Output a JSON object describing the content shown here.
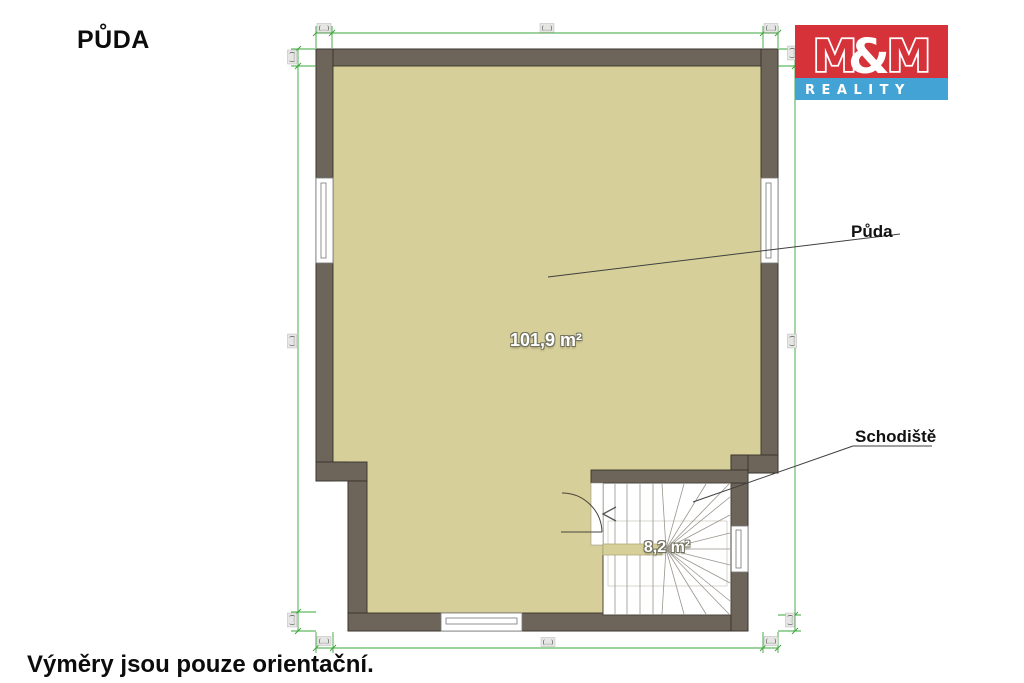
{
  "page": {
    "title": "PŮDA",
    "footer": "Výměry jsou pouze orientační."
  },
  "logo": {
    "m_left": "M",
    "ampersand": "&",
    "m_right": "M",
    "reality": "REALITY",
    "red": "#d6323a",
    "blue": "#44a3d5"
  },
  "plan": {
    "room_label": "Půda",
    "room_area": "101,9 m²",
    "stair_label": "Schodiště",
    "stair_area": "8,2 m²",
    "colors": {
      "floor": "#d7cf99",
      "wall": "#6d655a",
      "dimension_line": "#3aa43a"
    }
  },
  "dims": {
    "top_left": "(…)",
    "top_center": "(…)",
    "top_right": "(…)",
    "bottom_left": "(…)",
    "bottom_center": "(…)",
    "bottom_right": "(…)",
    "left_top": "(…)",
    "left_middle": "(…)",
    "left_bottom": "(…)",
    "right_top": "(…)",
    "right_middle": "(…)",
    "right_bottom": "(…)"
  }
}
